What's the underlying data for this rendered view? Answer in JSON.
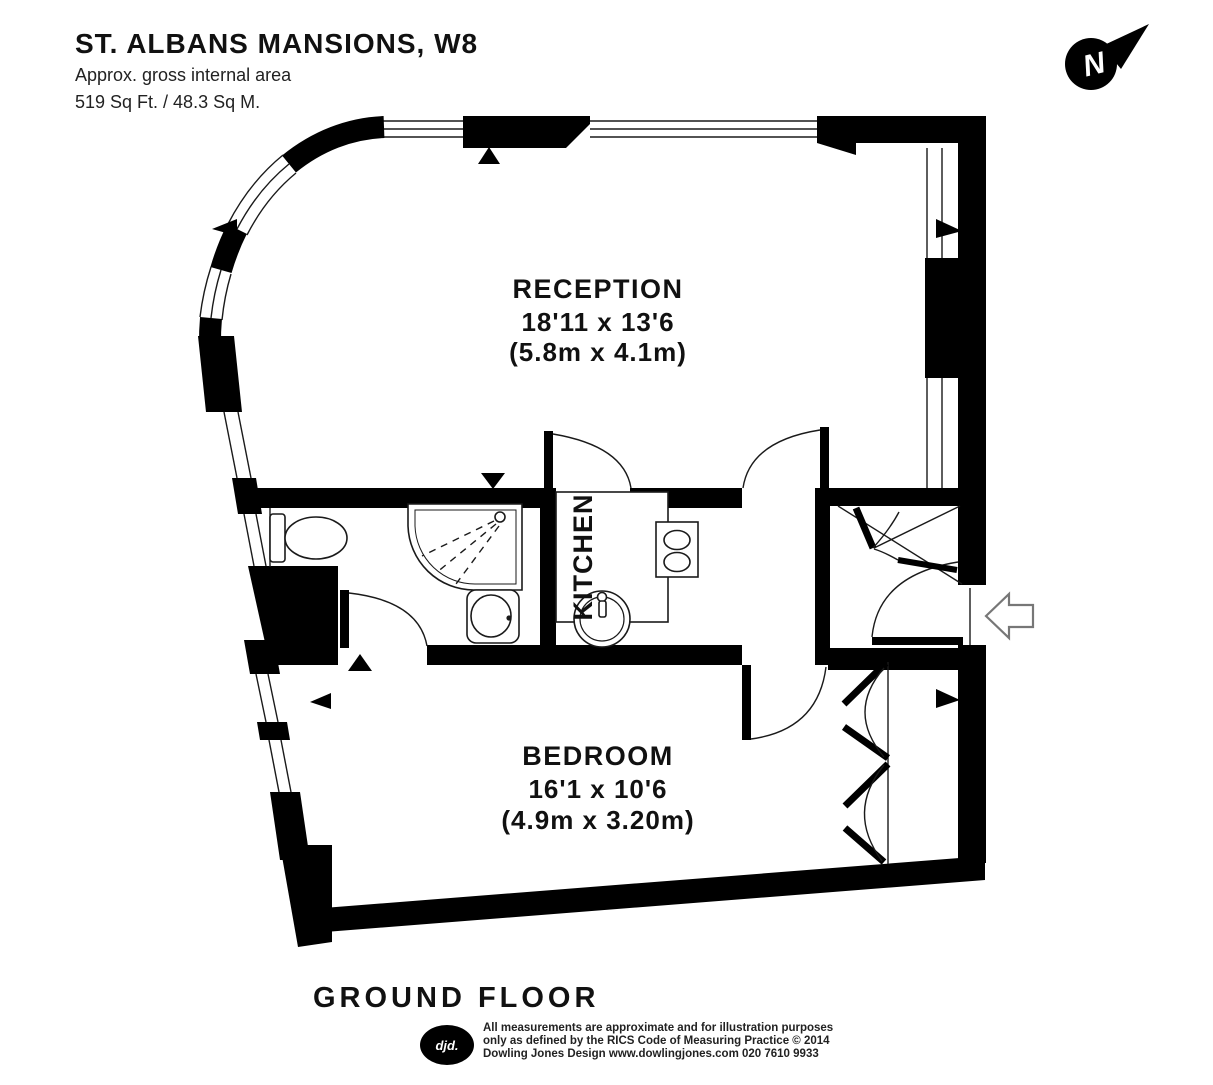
{
  "header": {
    "title": "ST. ALBANS MANSIONS, W8",
    "subtitle": "Approx. gross internal area",
    "area": "519 Sq Ft. / 48.3 Sq M."
  },
  "compass": {
    "north_label": "N"
  },
  "plan": {
    "reception": {
      "name": "RECEPTION",
      "dims_imperial": "18'11 x 13'6",
      "dims_metric": "(5.8m x 4.1m)"
    },
    "kitchen": {
      "name": "KITCHEN"
    },
    "bedroom": {
      "name": "BEDROOM",
      "dims_imperial": "16'1 x 10'6",
      "dims_metric": "(4.9m x 3.20m)"
    }
  },
  "floor_label": "GROUND FLOOR",
  "footer": {
    "logo_text": "djd.",
    "disclaimer_line1": "All measurements are approximate and for illustration purposes",
    "disclaimer_line2": "only as defined by the RICS Code of Measuring Practice © 2014",
    "disclaimer_line3": "Dowling Jones Design www.dowlingjones.com 020 7610 9933"
  },
  "colors": {
    "wall": "#000000",
    "background": "#ffffff"
  }
}
